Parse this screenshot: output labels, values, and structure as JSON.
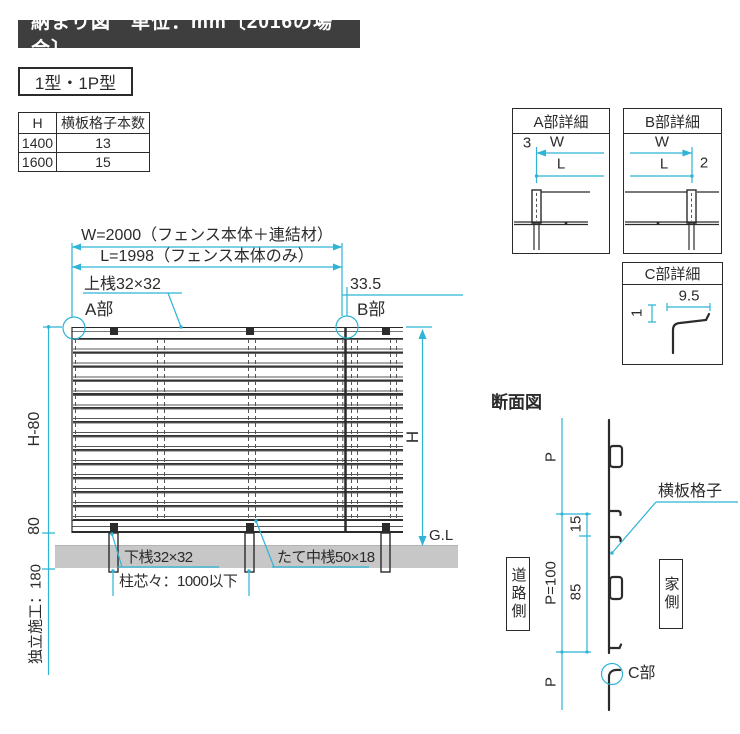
{
  "title": "納まり図　単位：mm〔2016の場合〕",
  "type_label": "1型・1P型",
  "spec_table": {
    "col_h": "H",
    "col_count": "横板格子本数",
    "rows": [
      [
        "1400",
        "13"
      ],
      [
        "1600",
        "15"
      ]
    ]
  },
  "elevation": {
    "dim_w": "W=2000（フェンス本体＋連結材）",
    "dim_l": "L=1998（フェンス本体のみ）",
    "top_rail_label": "上桟32×32",
    "dim_335": "33.5",
    "part_a": "A部",
    "part_b": "B部",
    "dim_h_minus_80": "H-80",
    "dim_80": "80",
    "dim_embed": "独立施工：180",
    "dim_h": "H",
    "ground_level": "G.L",
    "bottom_rail_label": "下桟32×32",
    "mid_rail_label": "たて中桟50×18",
    "post_pitch_label": "柱芯々：1000以下"
  },
  "detail_a": {
    "title": "A部詳細",
    "dim_3": "3",
    "dim_w": "W",
    "dim_l": "L"
  },
  "detail_b": {
    "title": "B部詳細",
    "dim_w": "W",
    "dim_l": "L",
    "dim_2": "2"
  },
  "detail_c": {
    "title": "C部詳細",
    "dim_95": "9.5",
    "dim_1": "1"
  },
  "section": {
    "title": "断面図",
    "dim_p_top": "P",
    "dim_15": "15",
    "dim_p100": "P=100",
    "dim_85": "85",
    "dim_p_bottom": "P",
    "road_side": "道路側",
    "house_side": "家側",
    "slat_label": "横板格子",
    "part_c": "C部"
  },
  "colors": {
    "dim_line": "#2db4d6",
    "ink": "#2b2b2b",
    "ground": "#c7c7c7",
    "title_bg": "#3e3e3e"
  }
}
